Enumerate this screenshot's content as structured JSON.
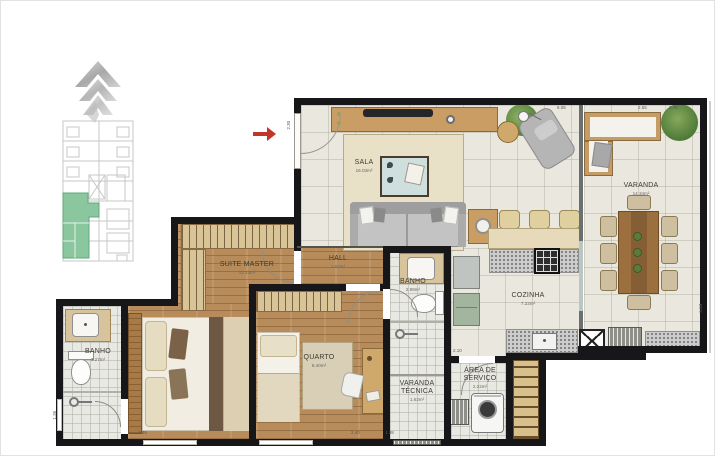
{
  "plan": {
    "title": "apartment-floor-plan",
    "rooms": [
      {
        "id": "sala",
        "name": "SALA",
        "area": "16.03m²"
      },
      {
        "id": "varanda",
        "name": "VARANDA",
        "area": "14.34m²"
      },
      {
        "id": "cozinha",
        "name": "COZINHA",
        "area": "7.22m²"
      },
      {
        "id": "suite-master",
        "name": "SUITE MASTER",
        "area": "13.13m²"
      },
      {
        "id": "hall",
        "name": "HALL",
        "area": "1.67m²"
      },
      {
        "id": "quarto",
        "name": "QUARTO",
        "area": "8.40m²"
      },
      {
        "id": "banho-suite",
        "name": "BANHO",
        "area": "3.27m²"
      },
      {
        "id": "banho-social",
        "name": "BANHO",
        "area": "2.98m²"
      },
      {
        "id": "varanda-tecnica",
        "name": "VARANDA\nTÉCNICA",
        "area": "1.62m²"
      },
      {
        "id": "area-servico",
        "name": "ÁREA DE\nSERVIÇO",
        "area": "2.22m²"
      }
    ],
    "dimensions": [
      "2.30",
      "6.05",
      "2.55",
      "2.76",
      "5.58",
      "2.10",
      "1.38",
      "2.89",
      "2.40",
      "1.36"
    ],
    "entry_arrow": {
      "color": "#c2352b",
      "direction": "right"
    },
    "keyplan": {
      "highlight_color": "#8bc79e",
      "outline_color": "#c7c7c7"
    },
    "palette": {
      "wall": "#17171a",
      "tile_floor": "#eae7df",
      "wood_floor": "#b78c5a",
      "closet": "#d9c497",
      "plant": "#6f9c4f",
      "logo_gray": "#b9b9b9"
    }
  }
}
